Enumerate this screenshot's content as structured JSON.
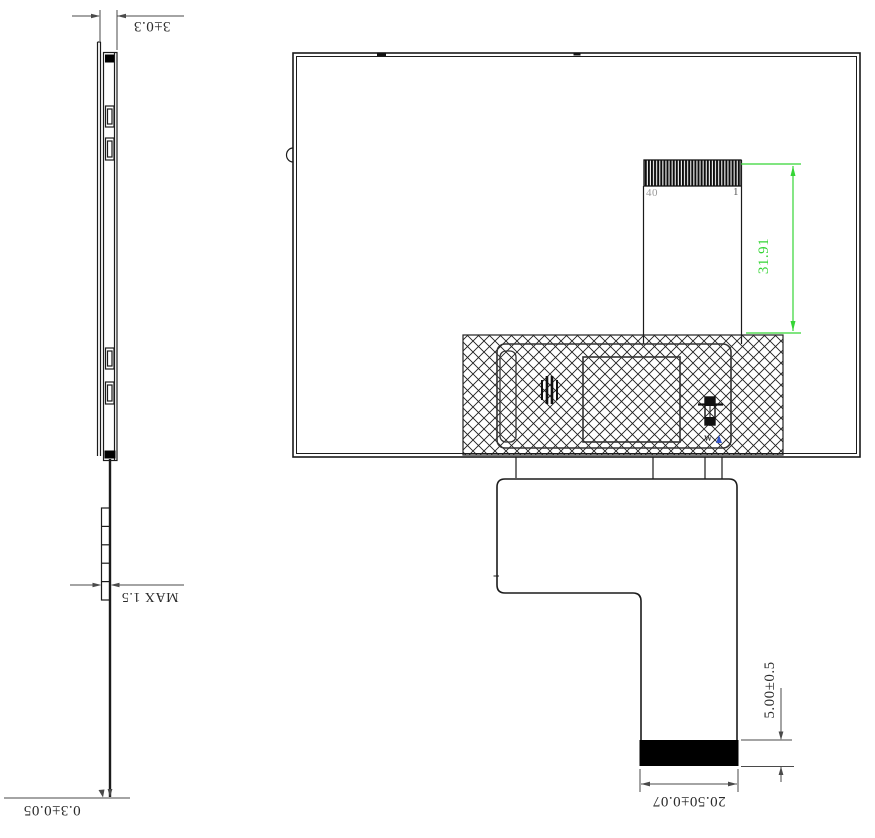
{
  "side_view": {
    "overall_thickness_dim": "3±0.3",
    "stiffener_dim": "MAX 1.5",
    "fpc_thickness_dim": "0.3±0.05"
  },
  "back_view": {
    "pin_label_left": "40",
    "pin_label_right": "1",
    "fpc_fold_length_dim": "31.91",
    "connector_tail_dim": "5.00±0.5",
    "connector_width_dim": "20.50±0.07",
    "component_mark": "W"
  },
  "colors": {
    "outline": "#1b1b1b",
    "dimension_line": "#4a4a4a",
    "highlight_green": "#35d535",
    "pin_label_gray": "#9a9a9a",
    "fill_black": "#000000",
    "tiny_blue_mark": "#3355cc"
  }
}
